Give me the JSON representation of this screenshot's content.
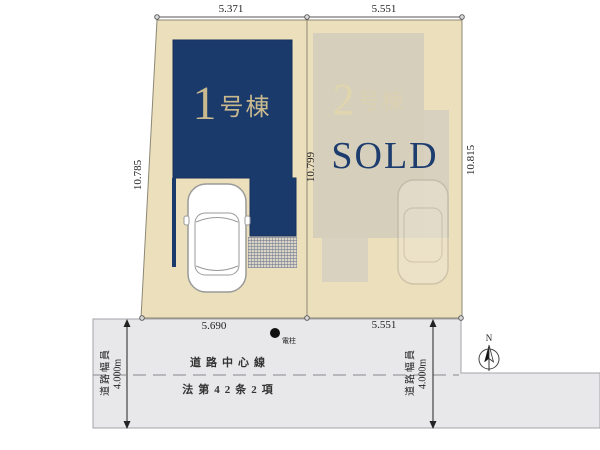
{
  "lots": {
    "lot1": {
      "number": "1",
      "suffix": "号棟",
      "width_top": "5.371",
      "frontage": "5.690",
      "depth_left": "10.785",
      "depth_right": "10.799"
    },
    "lot2": {
      "number": "2",
      "suffix": "号棟",
      "status": "SOLD",
      "width_top": "5.551",
      "frontage": "5.551",
      "depth_right": "10.815"
    }
  },
  "road": {
    "center_line_label": "道路中心線",
    "law_label": "法第42条2項",
    "width_label": "道路幅員",
    "width_value": "4.000m",
    "pole_label": "電柱"
  },
  "compass": {
    "north_label": "N"
  },
  "colors": {
    "building_navy": "#1b3a6c",
    "parcel_beige": "#ecdfbc",
    "label_gold": "#c9b98e",
    "road_gray": "#e8e8eb",
    "sold_navy": "#1e3d6f",
    "ghost_building": "#d6cfbc"
  }
}
